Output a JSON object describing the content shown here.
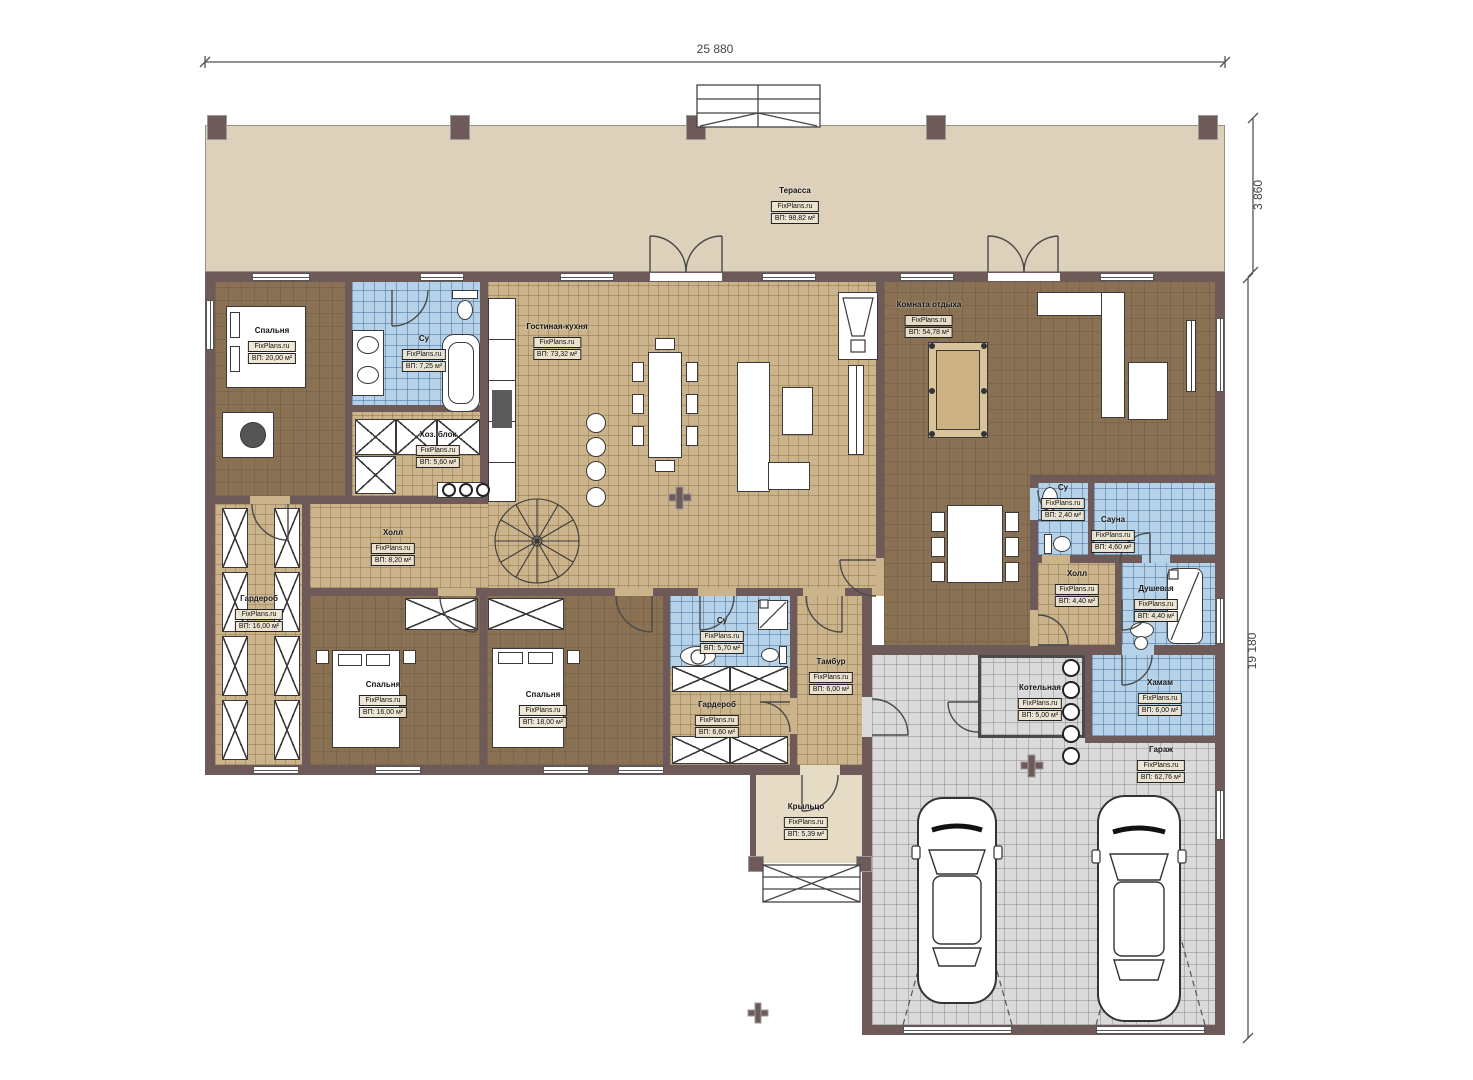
{
  "brand": "FixPlans.ru",
  "dimensions": {
    "width_total": "25 880",
    "terrace_depth": "3 860",
    "height_total": "19 180"
  },
  "rooms": [
    {
      "name": "Терасса",
      "area": "ВП: 98,82 м²"
    },
    {
      "name": "Спальня",
      "area": "ВП: 20,00 м²"
    },
    {
      "name": "Су",
      "area": "ВП: 7,25 м²"
    },
    {
      "name": "Хоз. блок",
      "area": "ВП: 5,60 м²"
    },
    {
      "name": "Гостиная-кухня",
      "area": "ВП: 73,32 м²"
    },
    {
      "name": "Комната отдыха",
      "area": "ВП: 54,78 м²"
    },
    {
      "name": "Холл",
      "area": "ВП: 8,20 м²"
    },
    {
      "name": "Гардероб",
      "area": "ВП: 16,00 м²"
    },
    {
      "name": "Спальня",
      "area": "ВП: 16,00 м²"
    },
    {
      "name": "Спальня",
      "area": "ВП: 18,00 м²"
    },
    {
      "name": "Су",
      "area": "ВП: 5,70 м²"
    },
    {
      "name": "Тамбур",
      "area": "ВП: 6,00 м²"
    },
    {
      "name": "Гардероб",
      "area": "ВП: 6,60 м²"
    },
    {
      "name": "Су",
      "area": "ВП: 2,40 м²"
    },
    {
      "name": "Сауна",
      "area": "ВП: 4,60 м²"
    },
    {
      "name": "Холл",
      "area": "ВП: 4,40 м²"
    },
    {
      "name": "Душевая",
      "area": "ВП: 4,40 м²"
    },
    {
      "name": "Хамам",
      "area": "ВП: 6,00 м²"
    },
    {
      "name": "Котельная",
      "area": "ВП: 5,00 м²"
    },
    {
      "name": "Гараж",
      "area": "ВП: 62,76 м²"
    },
    {
      "name": "Крыльцо",
      "area": "ВП: 5,39 м²"
    }
  ],
  "colors": {
    "wall": "#6e5b59",
    "floor_wood": "#cbb48c",
    "floor_room": "#8a7154",
    "floor_wet": "#b5d2e8",
    "floor_garage": "#dadada",
    "terrace": "#ddd1bb"
  }
}
